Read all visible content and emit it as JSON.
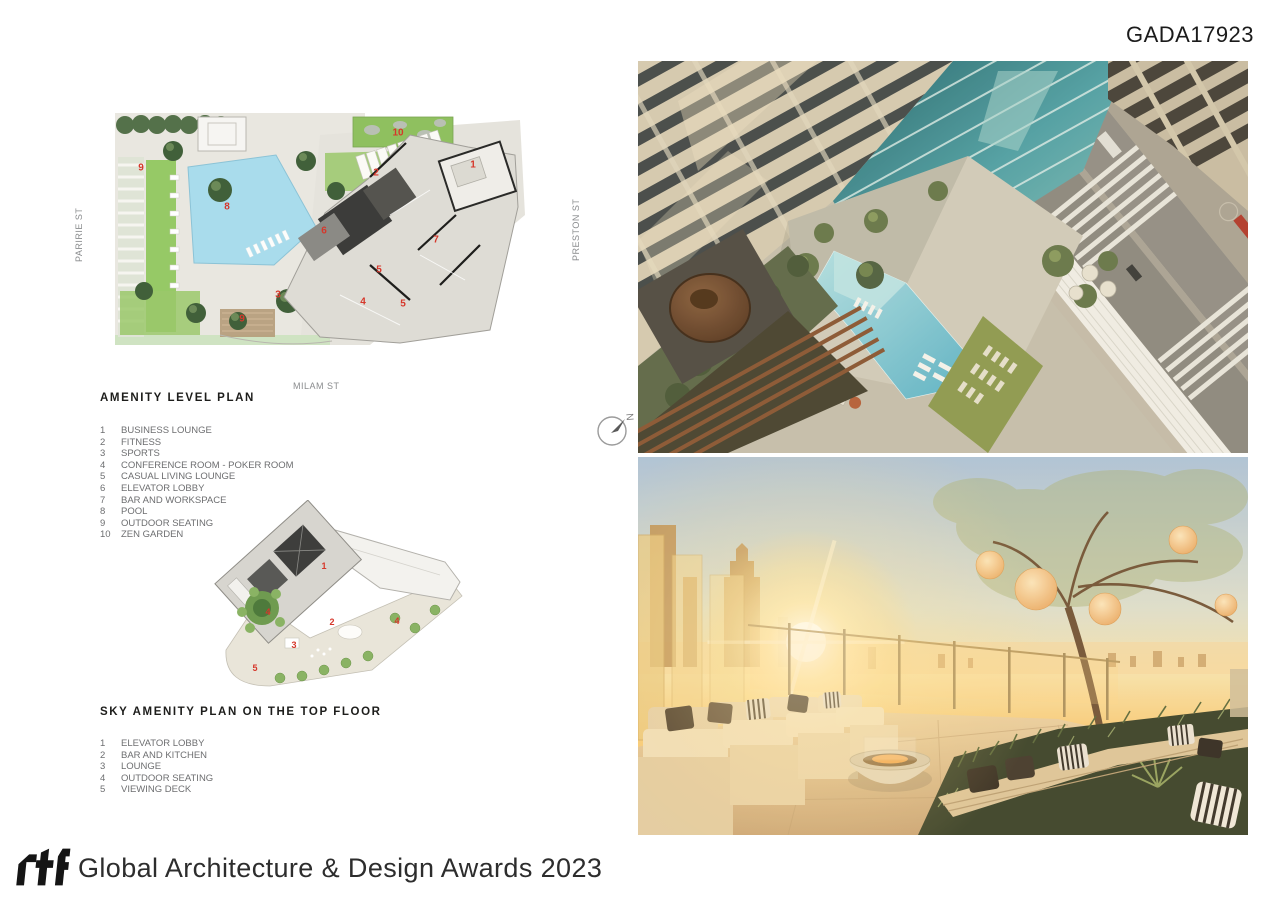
{
  "page": {
    "code": "GADA17923"
  },
  "plan1": {
    "title": "AMENITY LEVEL PLAN",
    "streets": {
      "left": "PARIRIE ST",
      "right": "PRESTON ST",
      "bottom": "MILAM ST"
    },
    "legend": [
      {
        "num": "1",
        "label": "BUSINESS LOUNGE"
      },
      {
        "num": "2",
        "label": "FITNESS"
      },
      {
        "num": "3",
        "label": "SPORTS"
      },
      {
        "num": "4",
        "label": "CONFERENCE ROOM - POKER ROOM"
      },
      {
        "num": "5",
        "label": "CASUAL LIVING LOUNGE"
      },
      {
        "num": "6",
        "label": "ELEVATOR LOBBY"
      },
      {
        "num": "7",
        "label": "BAR AND WORKSPACE"
      },
      {
        "num": "8",
        "label": "POOL"
      },
      {
        "num": "9",
        "label": "OUTDOOR SEATING"
      },
      {
        "num": "10",
        "label": "ZEN GARDEN"
      }
    ],
    "markers": [
      "9",
      "10",
      "1",
      "2",
      "8",
      "6",
      "7",
      "5",
      "3",
      "4",
      "5",
      "9"
    ]
  },
  "plan2": {
    "title": "SKY AMENITY PLAN ON THE TOP FLOOR",
    "legend": [
      {
        "num": "1",
        "label": "ELEVATOR LOBBY"
      },
      {
        "num": "2",
        "label": "BAR AND KITCHEN"
      },
      {
        "num": "3",
        "label": "LOUNGE"
      },
      {
        "num": "4",
        "label": "OUTDOOR SEATING"
      },
      {
        "num": "5",
        "label": "VIEWING DECK"
      }
    ],
    "markers": [
      "1",
      "4",
      "2",
      "4",
      "3",
      "5"
    ]
  },
  "compass": {
    "label": "N"
  },
  "footer": {
    "logo": "rtf",
    "title": "Global Architecture & Design Awards 2023"
  },
  "colors": {
    "marker": "#d6372b",
    "pool": "#a9dcec",
    "lawn": "#96c966",
    "legend_text": "#6d6e70",
    "heading_text": "#1d1d1b"
  }
}
